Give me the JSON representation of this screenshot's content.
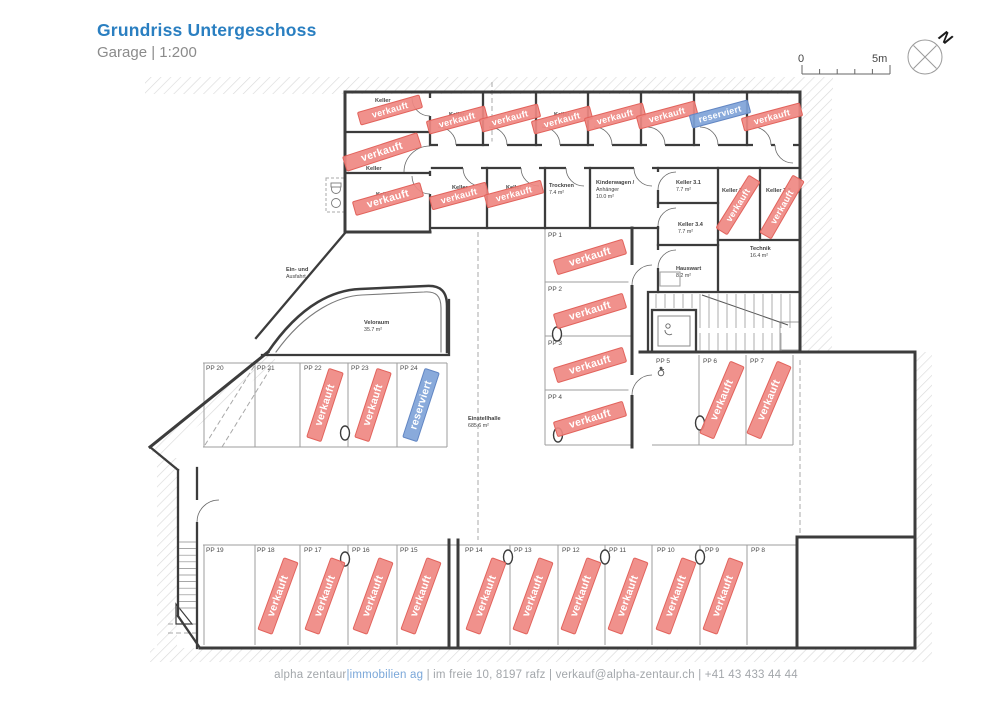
{
  "page": {
    "title": "Grundriss Untergeschoss",
    "subtitle": "Garage | 1:200"
  },
  "scalebar": {
    "zero": "0",
    "five": "5m"
  },
  "compass": {
    "label": "N"
  },
  "legend": {
    "sold": "verkauft",
    "reserved": "reserviert"
  },
  "colors": {
    "title_blue": "#2a7fc1",
    "sold_fill": "#ef8882",
    "sold_stroke": "#e2635c",
    "reserved_fill": "#7fa3d8",
    "reserved_stroke": "#6286c3",
    "wall": "#3c3c3c",
    "thin_line": "#9e9e9e",
    "plan_text": "#3f3f3f",
    "footer_gray": "#a3a7ab",
    "footer_blue": "#7aa7d9",
    "hatch": "#dadada"
  },
  "rooms": [
    {
      "x": 549,
      "y": 187,
      "lines": [
        "Trocknen",
        "7.4 m²"
      ]
    },
    {
      "x": 596,
      "y": 184,
      "lines": [
        "Kinderwagen /",
        "Anhänger",
        "10.0 m²"
      ]
    },
    {
      "x": 676,
      "y": 184,
      "lines": [
        "Keller 3.1",
        "7.7 m²"
      ]
    },
    {
      "x": 678,
      "y": 226,
      "lines": [
        "Keller 3.4",
        "7.7 m²"
      ]
    },
    {
      "x": 722,
      "y": 192,
      "lines": [
        "Keller 3.2"
      ]
    },
    {
      "x": 766,
      "y": 192,
      "lines": [
        "Keller 3.3"
      ]
    },
    {
      "x": 750,
      "y": 250,
      "lines": [
        "Technik",
        "16.4 m²"
      ]
    },
    {
      "x": 676,
      "y": 270,
      "lines": [
        "Hauswart",
        "8.2 m²"
      ]
    },
    {
      "x": 364,
      "y": 324,
      "lines": [
        "Veloraum",
        "35.7 m²"
      ]
    },
    {
      "x": 286,
      "y": 271,
      "lines": [
        "Ein- und",
        "Ausfahrt"
      ]
    },
    {
      "x": 468,
      "y": 420,
      "lines": [
        "Einstellhalle",
        "685.6 m²"
      ]
    },
    {
      "x": 375,
      "y": 102,
      "lines": [
        "Keller"
      ]
    },
    {
      "x": 366,
      "y": 170,
      "lines": [
        "Keller"
      ]
    },
    {
      "x": 376,
      "y": 196,
      "lines": [
        "Keller"
      ]
    },
    {
      "x": 452,
      "y": 189,
      "lines": [
        "Keller"
      ]
    },
    {
      "x": 506,
      "y": 189,
      "lines": [
        "Keller"
      ]
    },
    {
      "x": 449,
      "y": 116,
      "lines": [
        "Keller"
      ]
    },
    {
      "x": 554,
      "y": 116,
      "lines": [
        "Keller"
      ]
    }
  ],
  "spots": [
    {
      "label": "PP 1",
      "x": 548,
      "y": 237,
      "status": "sold"
    },
    {
      "label": "PP 2",
      "x": 548,
      "y": 291,
      "status": "sold"
    },
    {
      "label": "PP 3",
      "x": 548,
      "y": 345,
      "status": "sold"
    },
    {
      "label": "PP 4",
      "x": 548,
      "y": 399,
      "status": "sold"
    },
    {
      "label": "PP 5",
      "x": 656,
      "y": 363,
      "status": "free",
      "accessible": true
    },
    {
      "label": "PP 6",
      "x": 703,
      "y": 363,
      "status": "sold"
    },
    {
      "label": "PP 7",
      "x": 750,
      "y": 363,
      "status": "sold"
    },
    {
      "label": "PP 8",
      "x": 751,
      "y": 552,
      "status": "free"
    },
    {
      "label": "PP 9",
      "x": 705,
      "y": 552,
      "status": "sold"
    },
    {
      "label": "PP 10",
      "x": 657,
      "y": 552,
      "status": "sold"
    },
    {
      "label": "PP 11",
      "x": 609,
      "y": 552,
      "status": "sold"
    },
    {
      "label": "PP 12",
      "x": 562,
      "y": 552,
      "status": "sold"
    },
    {
      "label": "PP 13",
      "x": 514,
      "y": 552,
      "status": "sold"
    },
    {
      "label": "PP 14",
      "x": 465,
      "y": 552,
      "status": "sold"
    },
    {
      "label": "PP 15",
      "x": 400,
      "y": 552,
      "status": "sold"
    },
    {
      "label": "PP 16",
      "x": 352,
      "y": 552,
      "status": "sold"
    },
    {
      "label": "PP 17",
      "x": 304,
      "y": 552,
      "status": "sold"
    },
    {
      "label": "PP 18",
      "x": 257,
      "y": 552,
      "status": "sold"
    },
    {
      "label": "PP 19",
      "x": 206,
      "y": 552,
      "status": "free"
    },
    {
      "label": "PP 20",
      "x": 206,
      "y": 370,
      "status": "free"
    },
    {
      "label": "PP 21",
      "x": 257,
      "y": 370,
      "status": "free"
    },
    {
      "label": "PP 22",
      "x": 304,
      "y": 370,
      "status": "sold"
    },
    {
      "label": "PP 23",
      "x": 351,
      "y": 370,
      "status": "sold"
    },
    {
      "label": "PP 24",
      "x": 400,
      "y": 370,
      "status": "reserved"
    }
  ],
  "stamps": [
    {
      "s": "sold",
      "x": 457,
      "y": 120,
      "a": -15,
      "w": 60,
      "h": 13
    },
    {
      "s": "sold",
      "x": 510,
      "y": 118,
      "a": -15,
      "w": 60,
      "h": 13
    },
    {
      "s": "sold",
      "x": 562,
      "y": 120,
      "a": -15,
      "w": 60,
      "h": 13
    },
    {
      "s": "sold",
      "x": 615,
      "y": 117,
      "a": -15,
      "w": 60,
      "h": 13
    },
    {
      "s": "sold",
      "x": 667,
      "y": 115,
      "a": -15,
      "w": 60,
      "h": 13
    },
    {
      "s": "reserved",
      "x": 720,
      "y": 114,
      "a": -15,
      "w": 60,
      "h": 13
    },
    {
      "s": "sold",
      "x": 772,
      "y": 117,
      "a": -15,
      "w": 60,
      "h": 13
    },
    {
      "s": "sold",
      "x": 390,
      "y": 110,
      "a": -16,
      "w": 64,
      "h": 13
    },
    {
      "s": "sold",
      "x": 382,
      "y": 152,
      "a": -18,
      "w": 78,
      "h": 15
    },
    {
      "s": "sold",
      "x": 388,
      "y": 199,
      "a": -16,
      "w": 70,
      "h": 14
    },
    {
      "s": "sold",
      "x": 459,
      "y": 196,
      "a": -15,
      "w": 58,
      "h": 13
    },
    {
      "s": "sold",
      "x": 514,
      "y": 194,
      "a": -15,
      "w": 58,
      "h": 13
    },
    {
      "s": "sold",
      "x": 738,
      "y": 205,
      "a": -58,
      "w": 62,
      "h": 13
    },
    {
      "s": "sold",
      "x": 782,
      "y": 207,
      "a": -60,
      "w": 66,
      "h": 13
    },
    {
      "s": "sold",
      "x": 590,
      "y": 257,
      "a": -17,
      "w": 72,
      "h": 15
    },
    {
      "s": "sold",
      "x": 590,
      "y": 311,
      "a": -17,
      "w": 72,
      "h": 15
    },
    {
      "s": "sold",
      "x": 590,
      "y": 365,
      "a": -17,
      "w": 72,
      "h": 15
    },
    {
      "s": "sold",
      "x": 590,
      "y": 419,
      "a": -17,
      "w": 72,
      "h": 15
    },
    {
      "s": "sold",
      "x": 722,
      "y": 400,
      "a": -67,
      "w": 78,
      "h": 15
    },
    {
      "s": "sold",
      "x": 769,
      "y": 400,
      "a": -67,
      "w": 78,
      "h": 15
    },
    {
      "s": "sold",
      "x": 325,
      "y": 405,
      "a": -72,
      "w": 72,
      "h": 15
    },
    {
      "s": "sold",
      "x": 373,
      "y": 405,
      "a": -72,
      "w": 72,
      "h": 15
    },
    {
      "s": "reserved",
      "x": 421,
      "y": 405,
      "a": -72,
      "w": 72,
      "h": 15
    },
    {
      "s": "sold",
      "x": 278,
      "y": 596,
      "a": -70,
      "w": 76,
      "h": 15
    },
    {
      "s": "sold",
      "x": 325,
      "y": 596,
      "a": -70,
      "w": 76,
      "h": 15
    },
    {
      "s": "sold",
      "x": 373,
      "y": 596,
      "a": -70,
      "w": 76,
      "h": 15
    },
    {
      "s": "sold",
      "x": 421,
      "y": 596,
      "a": -70,
      "w": 76,
      "h": 15
    },
    {
      "s": "sold",
      "x": 486,
      "y": 596,
      "a": -70,
      "w": 76,
      "h": 15
    },
    {
      "s": "sold",
      "x": 533,
      "y": 596,
      "a": -70,
      "w": 76,
      "h": 15
    },
    {
      "s": "sold",
      "x": 581,
      "y": 596,
      "a": -70,
      "w": 76,
      "h": 15
    },
    {
      "s": "sold",
      "x": 628,
      "y": 596,
      "a": -70,
      "w": 76,
      "h": 15
    },
    {
      "s": "sold",
      "x": 676,
      "y": 596,
      "a": -70,
      "w": 76,
      "h": 15
    },
    {
      "s": "sold",
      "x": 723,
      "y": 596,
      "a": -70,
      "w": 76,
      "h": 15
    }
  ],
  "footer": {
    "part1": "alpha zentaur",
    "part2": "|immobilien ag",
    "part3": " | im freie 10, 8197 rafz | verkauf@alpha-zentaur.ch | +41 43 433 44 44"
  }
}
